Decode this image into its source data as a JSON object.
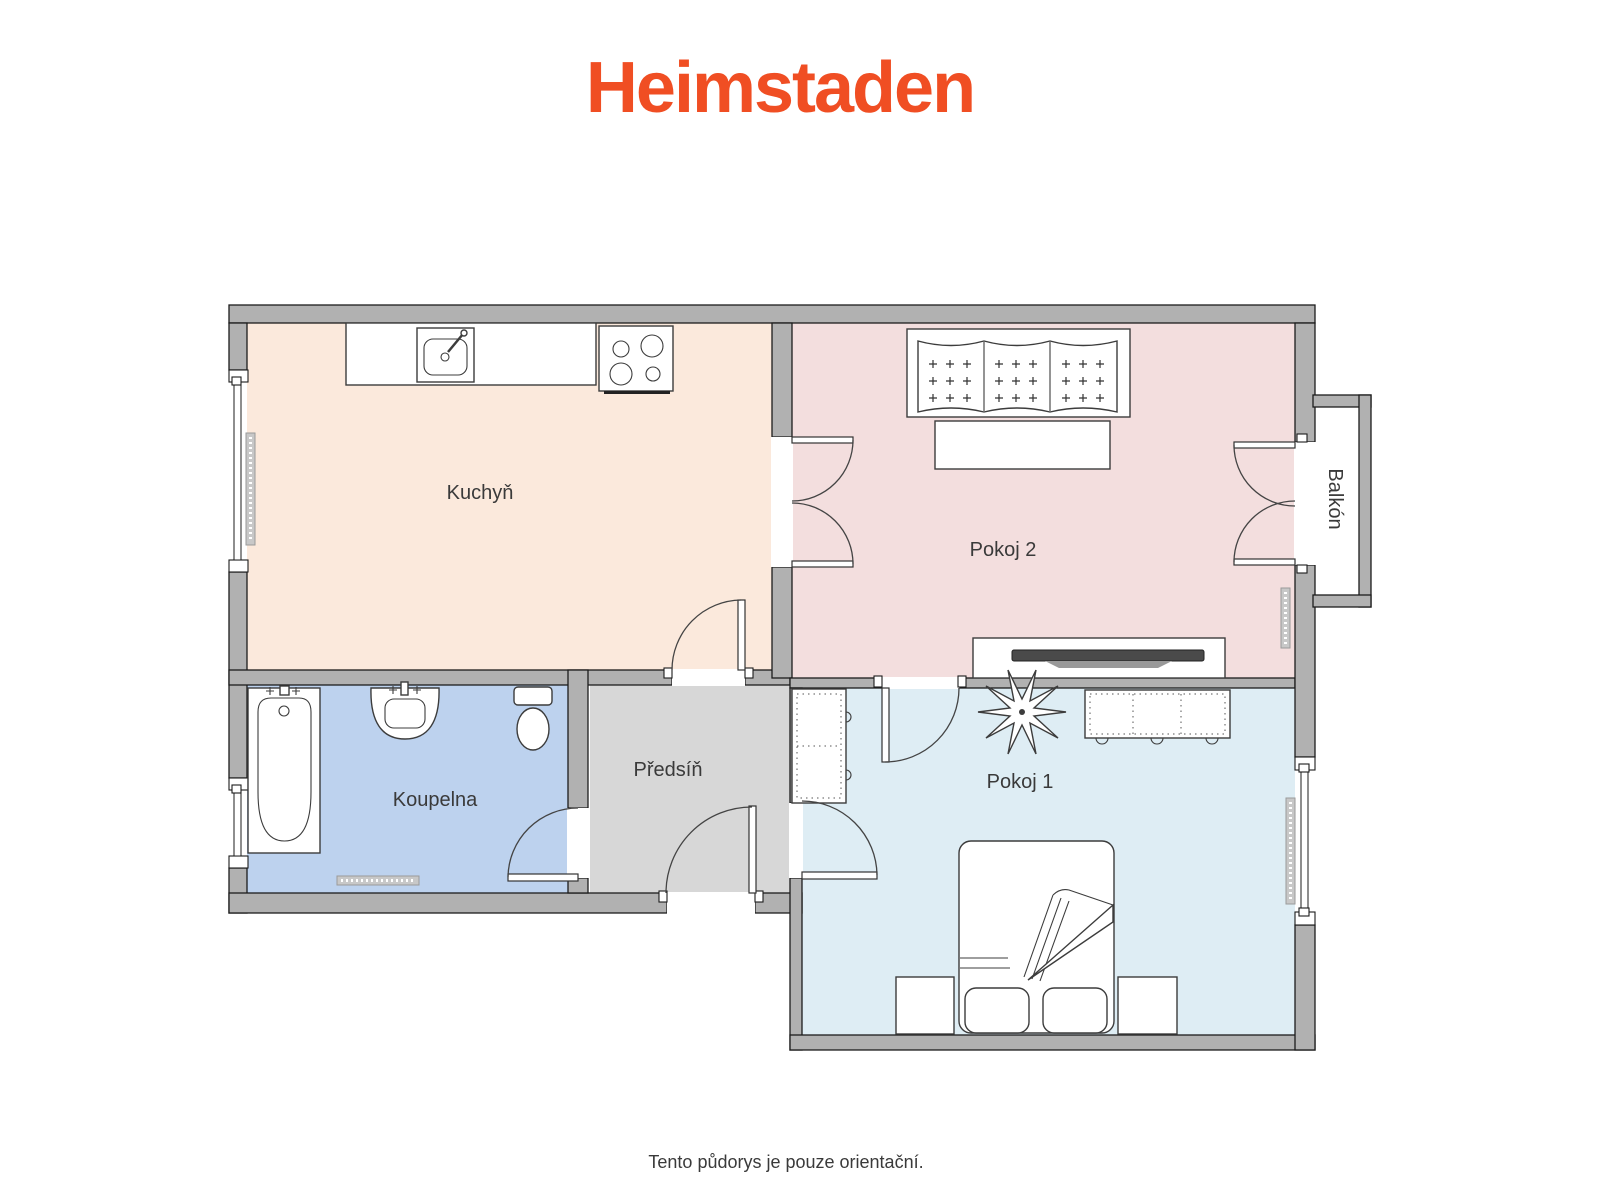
{
  "logo": {
    "text": "Heimstaden",
    "color": "#F04E23"
  },
  "rooms": {
    "kuchyn": {
      "label": "Kuchyň",
      "floor_color": "#FBE9DC"
    },
    "pokoj2": {
      "label": "Pokoj 2",
      "floor_color": "#F3DEDE"
    },
    "koupelna": {
      "label": "Koupelna",
      "floor_color": "#BDD2EE"
    },
    "predsin": {
      "label": "Předsíň",
      "floor_color": "#D7D7D7"
    },
    "pokoj1": {
      "label": "Pokoj 1",
      "floor_color": "#DEEDF4"
    },
    "balkon": {
      "label": "Balkón",
      "floor_color": "#FFFFFF"
    }
  },
  "palette": {
    "wall": "#B1B1B1",
    "outline": "#1C1C1C",
    "fixture_stroke": "#3C3C3C",
    "label_color": "#3A3A3A",
    "tv": "#4A4A4A",
    "radiator": "#C8C8C8"
  },
  "footer": {
    "disclaimer": "Tento půdorys je pouze orientační."
  }
}
